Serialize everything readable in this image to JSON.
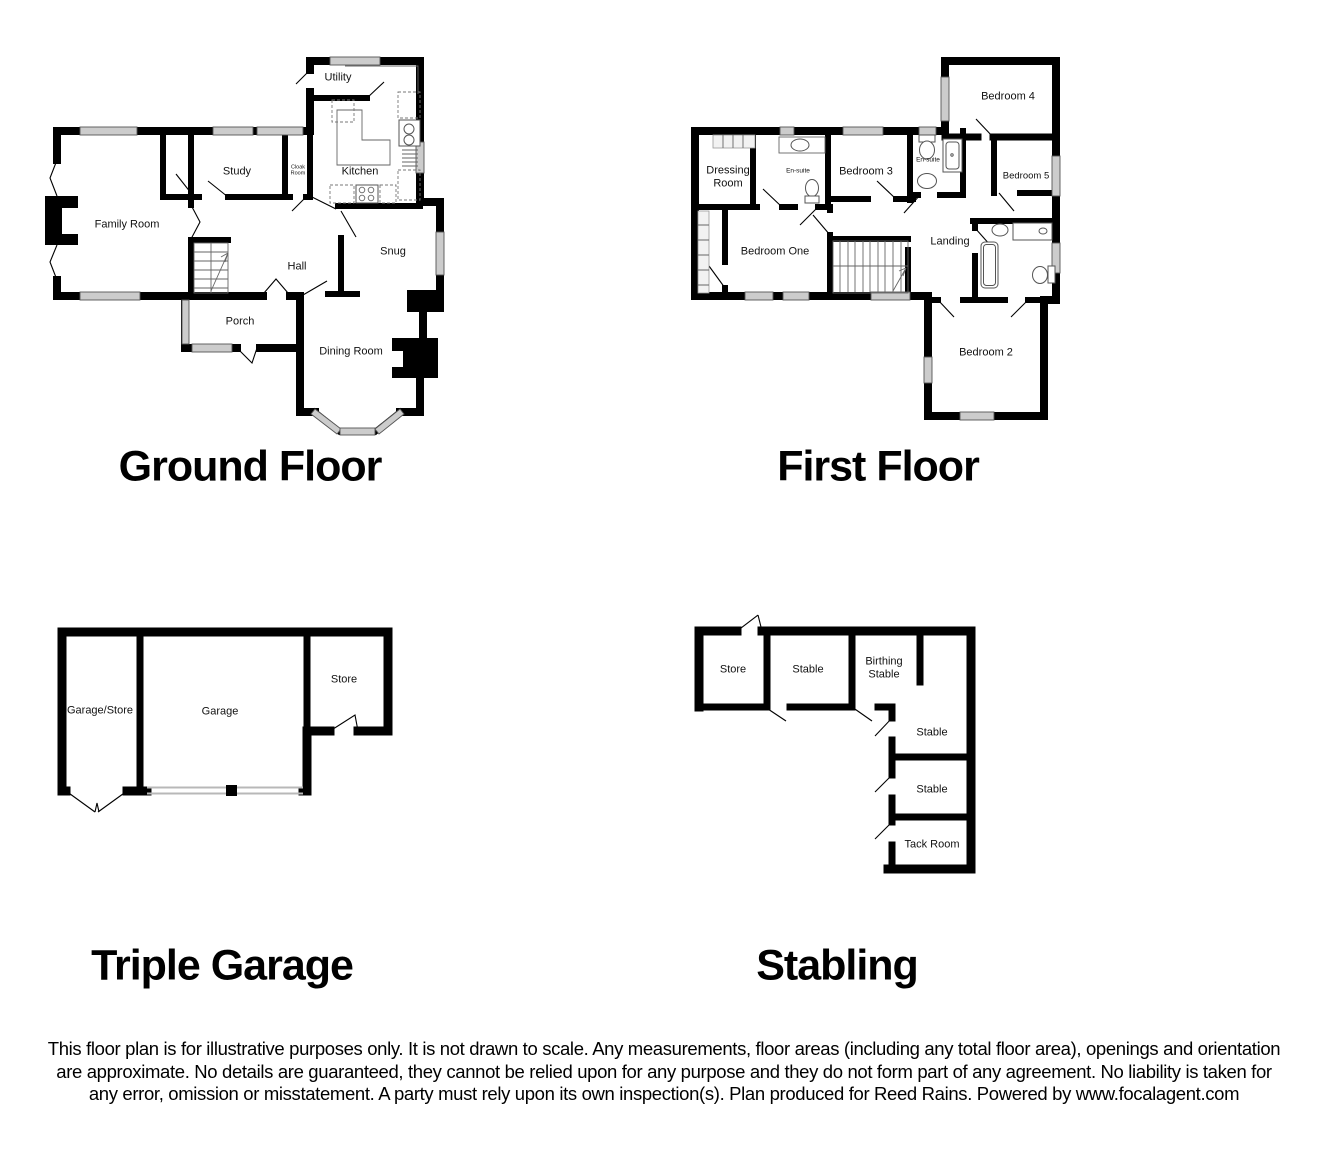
{
  "plans": {
    "ground": {
      "title": "Ground Floor",
      "rooms": {
        "family_room": "Family Room",
        "study": "Study",
        "cloak_room": "Cloak Room",
        "kitchen": "Kitchen",
        "utility": "Utility",
        "hall": "Hall",
        "snug": "Snug",
        "porch": "Porch",
        "dining_room": "Dining Room"
      }
    },
    "first": {
      "title": "First Floor",
      "rooms": {
        "dressing_room": "Dressing Room",
        "ensuite_a": "En-suite",
        "bedroom_3": "Bedroom 3",
        "ensuite_b": "En-suite",
        "bedroom_4": "Bedroom 4",
        "bedroom_5": "Bedroom 5",
        "bedroom_one": "Bedroom One",
        "landing": "Landing",
        "bedroom_2": "Bedroom 2"
      }
    },
    "garage": {
      "title": "Triple Garage",
      "rooms": {
        "garage_store": "Garage/Store",
        "garage": "Garage",
        "store": "Store"
      }
    },
    "stabling": {
      "title": "Stabling",
      "rooms": {
        "store": "Store",
        "stable_top": "Stable",
        "birthing_stable": "Birthing Stable",
        "stable_mid": "Stable",
        "stable_lower": "Stable",
        "tack_room": "Tack Room"
      }
    }
  },
  "footer": {
    "disclaimer": "This floor plan is for illustrative purposes only. It is not drawn to scale. Any measurements, floor areas (including any total floor area), openings and orientation are approximate. No details are guaranteed, they cannot be relied upon for any purpose and they do not form part of any agreement. No liability is taken for any error, omission or misstatement. A party must rely upon its own inspection(s). Plan produced for Reed Rains. Powered by www.focalagent.com"
  },
  "colors": {
    "wall": "#000000",
    "window_fill": "#cccccc",
    "window_stroke": "#555555",
    "text": "#000000"
  }
}
